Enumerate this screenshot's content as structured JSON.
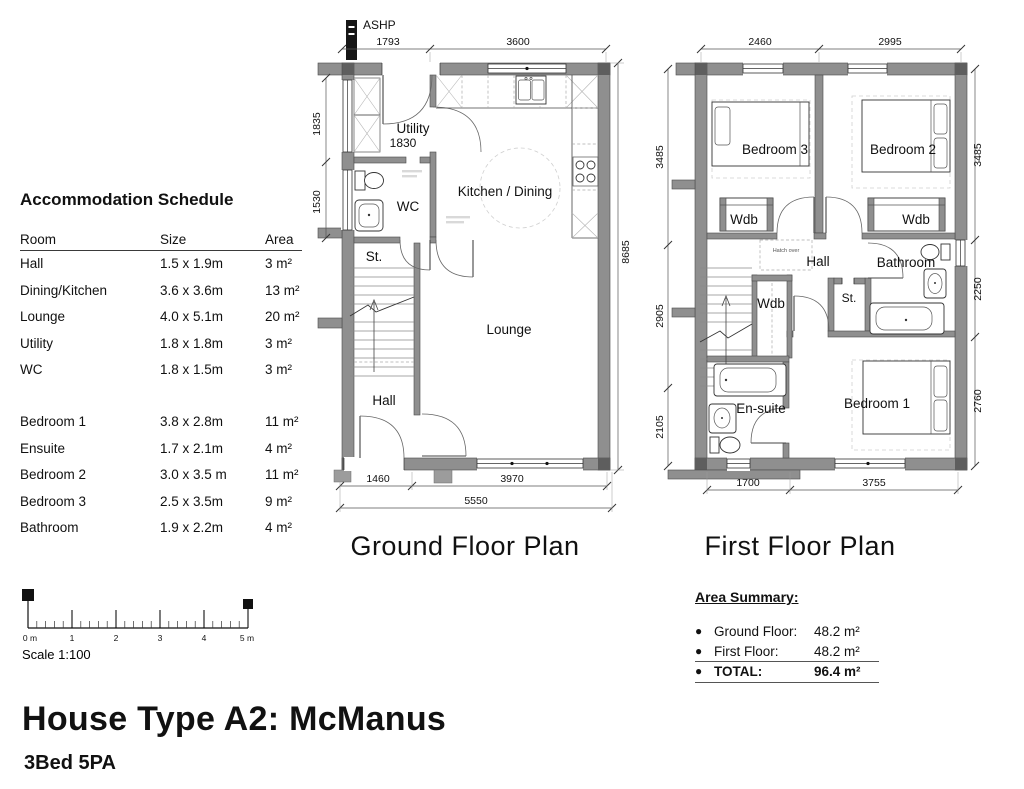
{
  "schedule": {
    "title": "Accommodation Schedule",
    "columns": {
      "room": "Room",
      "size": "Size",
      "area": "Area"
    },
    "rows_a": [
      {
        "room": "Hall",
        "size": "1.5 x 1.9m",
        "area": "3 m²"
      },
      {
        "room": "Dining/Kitchen",
        "size": "3.6 x 3.6m",
        "area": "13 m²"
      },
      {
        "room": "Lounge",
        "size": "4.0 x 5.1m",
        "area": "20 m²"
      },
      {
        "room": "Utility",
        "size": "1.8 x 1.8m",
        "area": "3 m²"
      },
      {
        "room": "WC",
        "size": "1.8 x 1.5m",
        "area": "3 m²"
      }
    ],
    "rows_b": [
      {
        "room": "Bedroom 1",
        "size": "3.8 x 2.8m",
        "area": "11 m²"
      },
      {
        "room": "Ensuite",
        "size": "1.7 x 2.1m",
        "area": "4 m²"
      },
      {
        "room": "Bedroom 2",
        "size": "3.0 x 3.5 m",
        "area": "11 m²"
      },
      {
        "room": "Bedroom 3",
        "size": "2.5 x 3.5m",
        "area": "9 m²"
      },
      {
        "room": "Bathroom",
        "size": "1.9 x 2.2m",
        "area": "4 m²"
      }
    ]
  },
  "ground_floor": {
    "title": "Ground Floor Plan",
    "ashp": "ASHP",
    "rooms": {
      "utility": "Utility",
      "utility_dim": "1830",
      "wc": "WC",
      "st": "St.",
      "kitchen": "Kitchen / Dining",
      "lounge": "Lounge",
      "hall": "Hall"
    },
    "dims": {
      "top": [
        "1793",
        "3600"
      ],
      "left": [
        "1835",
        "1530"
      ],
      "right": [
        "8685"
      ],
      "bottom": [
        "1460",
        "3970"
      ],
      "total": "5550"
    }
  },
  "first_floor": {
    "title": "First Floor Plan",
    "rooms": {
      "bedroom3": "Bedroom 3",
      "bedroom2": "Bedroom 2",
      "bedroom1": "Bedroom 1",
      "wdb": "Wdb",
      "hall": "Hall",
      "bathroom": "Bathroom",
      "st": "St.",
      "ensuite": "En-suite",
      "hatch": "Hatch over"
    },
    "dims": {
      "top": [
        "2460",
        "2995"
      ],
      "left": [
        "3485",
        "2905",
        "2105"
      ],
      "right": [
        "3485",
        "2250",
        "2760"
      ],
      "bottom": [
        "1700",
        "3755"
      ]
    }
  },
  "area_summary": {
    "title": "Area Summary:",
    "rows": [
      {
        "label": "Ground Floor:",
        "value": "48.2 m²"
      },
      {
        "label": "First Floor:",
        "value": "48.2 m²"
      },
      {
        "label": "TOTAL:",
        "value": "96.4 m²"
      }
    ]
  },
  "scale_bar": {
    "ticks": [
      "0 m",
      "1",
      "2",
      "3",
      "4",
      "5 m"
    ],
    "caption": "Scale 1:100"
  },
  "footer": {
    "title": "House Type A2: McManus",
    "subtitle": "3Bed 5PA"
  }
}
